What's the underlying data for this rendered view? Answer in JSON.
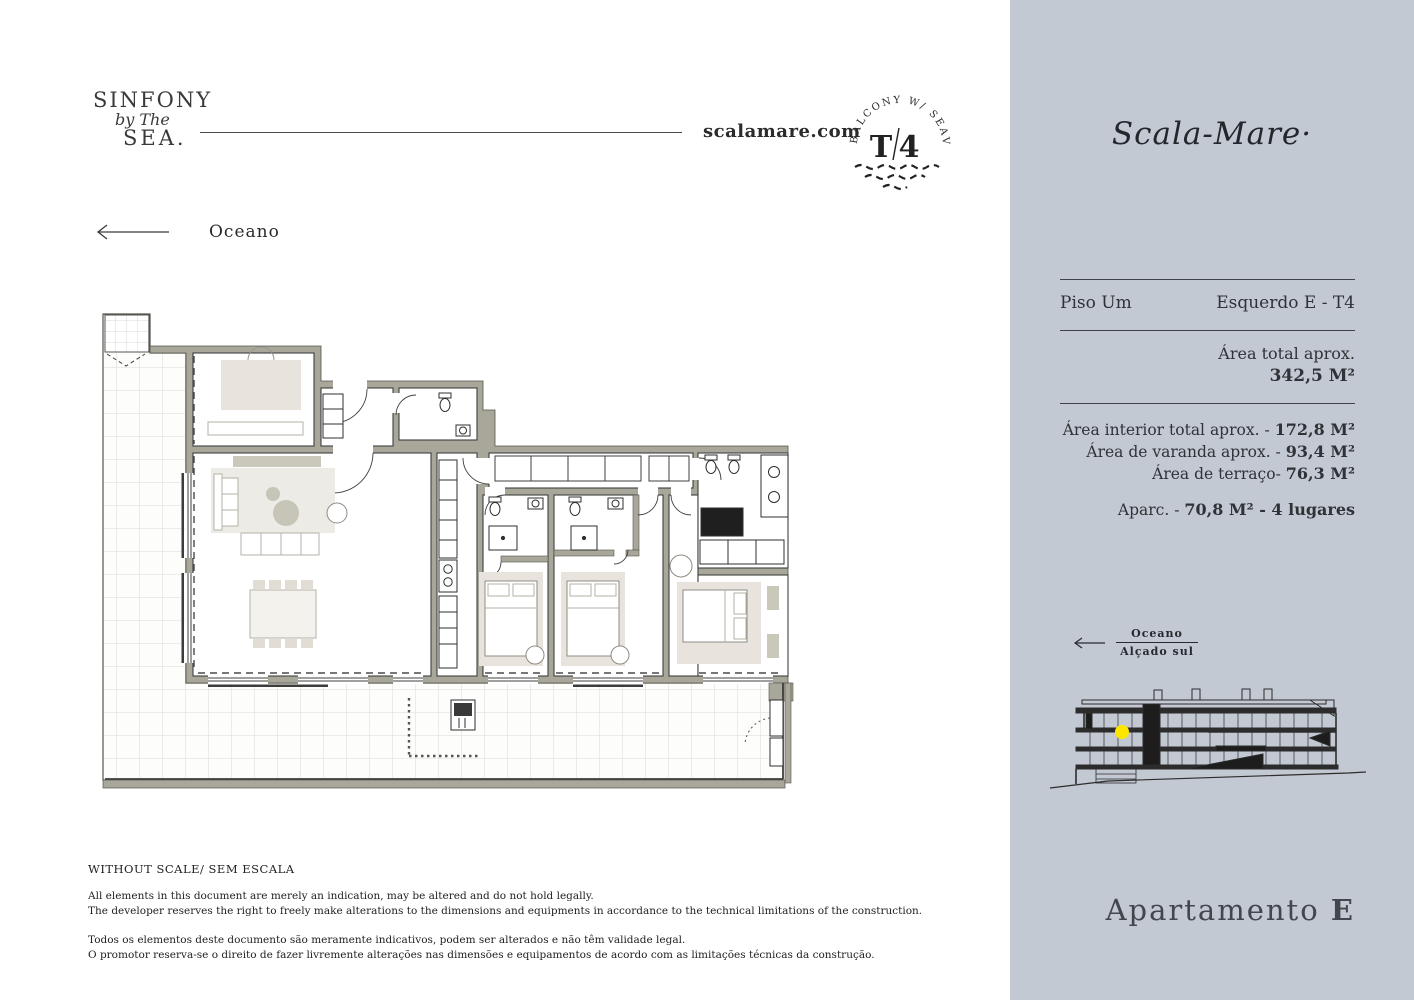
{
  "header": {
    "logo_line1": "SINFONY",
    "logo_line2": "by The",
    "logo_line3": "SEA.",
    "website": "scalamare.com",
    "badge": {
      "arc_text": "BALCONY W/ SEAVIEW",
      "unit_t": "T",
      "unit_n": "4"
    },
    "orientation_label": "Oceano"
  },
  "panel": {
    "background_color": "#c3c9d2",
    "brand": "Scala-Mare·",
    "floor_label": "Piso Um",
    "unit_label": "Esquerdo E - T4",
    "total_area_label": "Área total aprox.",
    "total_area_value": "342,5 M²",
    "areas": [
      {
        "label": "Área interior total aprox. - ",
        "value": "172,8 M²"
      },
      {
        "label": "Área de varanda aprox. - ",
        "value": "93,4 M²"
      },
      {
        "label": "Área de terraço- ",
        "value": "76,3 M²"
      }
    ],
    "parking_label": "Aparc. -  ",
    "parking_value": "70,8 M² - 4 lugares",
    "elevation": {
      "ocean_label": "Oceano",
      "facade_label": "Alçado sul",
      "marker_color": "#ffe600"
    },
    "apartment_title_prefix": "Apartamento ",
    "apartment_letter": "E"
  },
  "floorplan": {
    "wall_color": "#a8a79a",
    "furniture_color": "#e8e3dc",
    "rug_color": "#edebe6",
    "tile_line_color": "#d9d9d7"
  },
  "footer": {
    "scale_note": "WITHOUT SCALE/ SEM ESCALA",
    "en_line1": "All elements in this document are merely an indication, may be altered and do not hold legally.",
    "en_line2": "The developer reserves the right to freely make alterations to the dimensions and equipments in accordance to the technical limitations of the construction.",
    "pt_line1": "Todos os elementos deste documento são meramente indicativos, podem ser alterados e não têm validade legal.",
    "pt_line2": "O promotor reserva-se o direito de fazer livremente alterações nas dimensões e equipamentos de acordo com as limitações técnicas da construção."
  }
}
